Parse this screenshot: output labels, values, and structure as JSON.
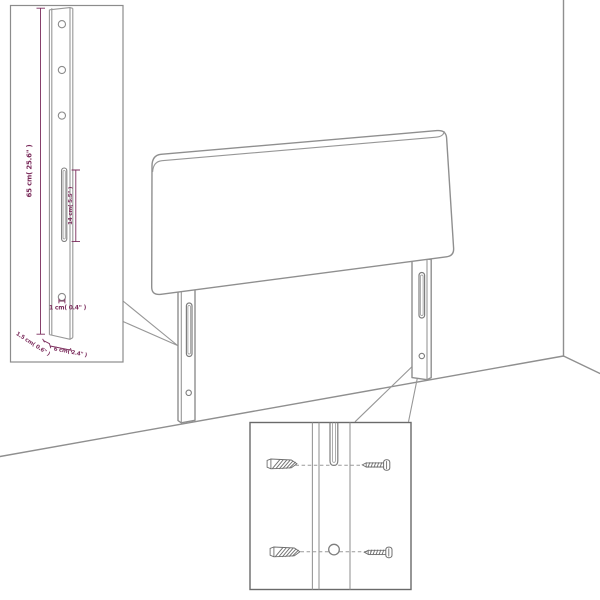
{
  "diagram_title": "Headboard with legs assembly dimension diagram",
  "colors": {
    "background": "#ffffff",
    "line_gray": "#8f8f8f",
    "dimension_purple": "#7b2c5c",
    "inset_border": "#6a6a6a"
  },
  "leg_detail_inset": {
    "height_label": "65 cm( 25.6\" )",
    "slot_label": "14 cm( 5.5\" )",
    "hole_label": "1 cm( 0.4\" )",
    "depth_label": "1.5 cm( 0.6\" )",
    "width_label": "6 cm( 2.4\" )"
  }
}
